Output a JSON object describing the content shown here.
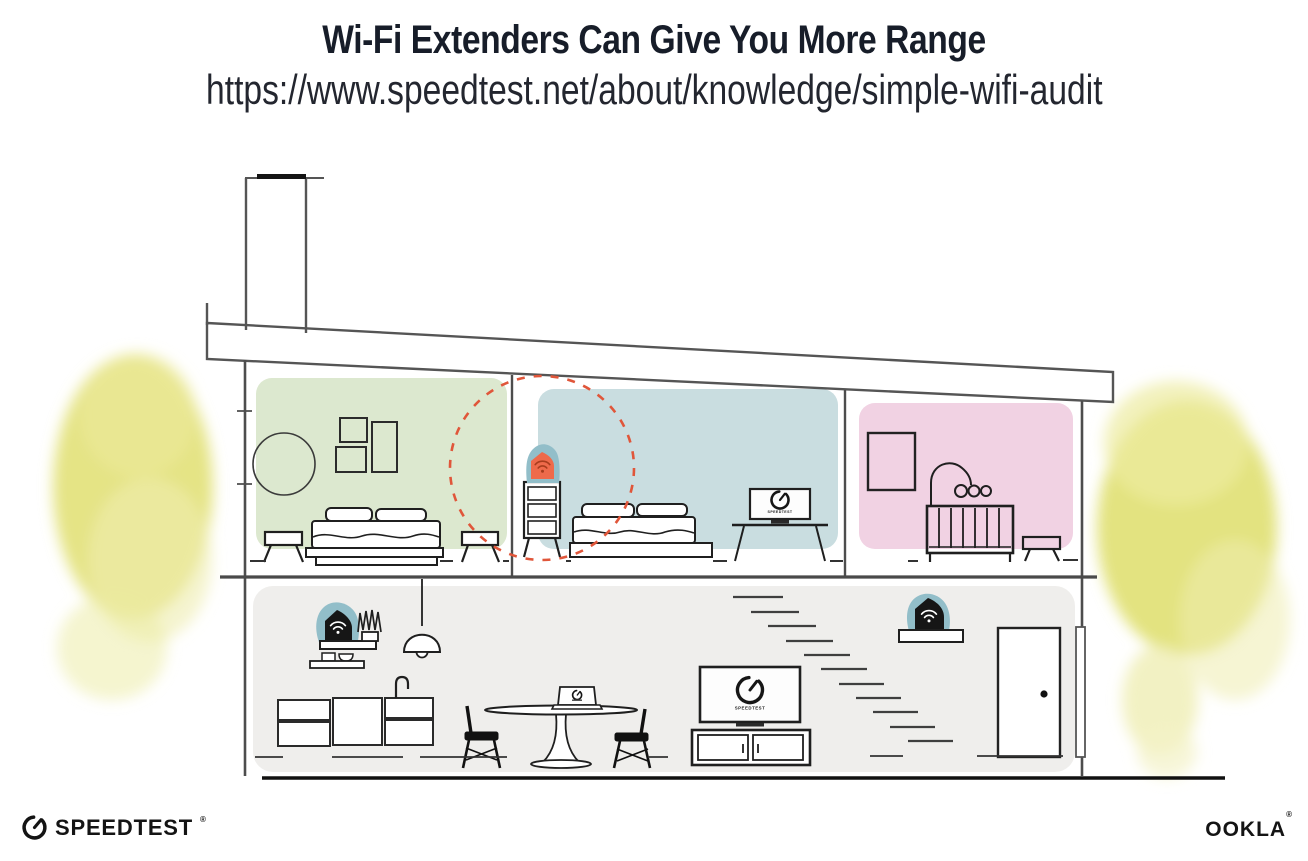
{
  "header": {
    "title": "Wi-Fi Extenders Can Give You More Range",
    "url": "https://www.speedtest.net/about/knowledge/simple-wifi-audit"
  },
  "scene": {
    "bedroom_tv_label": "SPEEDTEST",
    "living_room_tv_label": "SPEEDTEST",
    "icons": {
      "extender_badge": "wifi-icon",
      "left_shelf_router": "wifi-icon",
      "right_shelf_router": "wifi-icon",
      "tv_screens": "speedtest-gauge-icon",
      "footer_logo": "speedtest-gauge-icon"
    }
  },
  "footer": {
    "speedtest_logo_text": "SPEEDTEST",
    "speedtest_trademark": "®",
    "ookla_logo_text": "OOKLA",
    "ookla_trademark": "®"
  },
  "colors": {
    "room_green": "#dce8cf",
    "room_blue": "#c9dde0",
    "room_pink": "#f1d2e3",
    "lower_floor_gray": "#efeeec",
    "foliage_yellow": "#e2e178",
    "foliage_yellow_light": "#eceb9f",
    "extender_orange": "#ee6a4b",
    "badge_teal": "#92bec9",
    "coverage_circle_red": "#e0563a",
    "line_dark": "#4d4d4d",
    "ink_black": "#161616"
  }
}
